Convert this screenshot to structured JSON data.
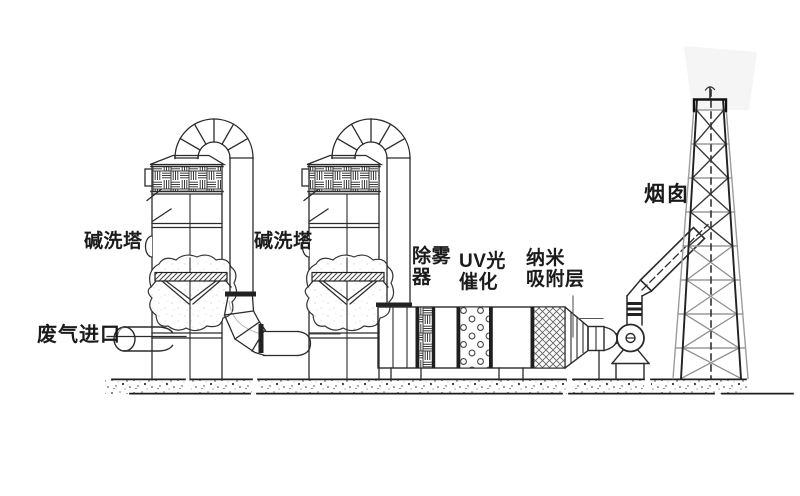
{
  "diagram": {
    "labels": {
      "scrubber_tower_1": "碱洗塔",
      "scrubber_tower_2": "碱洗塔",
      "waste_gas_inlet": "废气进口",
      "demister": "除雾\n器",
      "uv_photocatalysis": "UV光\n催化",
      "nano_adsorption_layer": "纳米\n吸附层",
      "chimney": "烟囱"
    },
    "colors": {
      "line": "#2b2b2b",
      "lattice_gray": "#9c9c9c",
      "plume": "#f5f5f5",
      "background": "#ffffff"
    }
  }
}
